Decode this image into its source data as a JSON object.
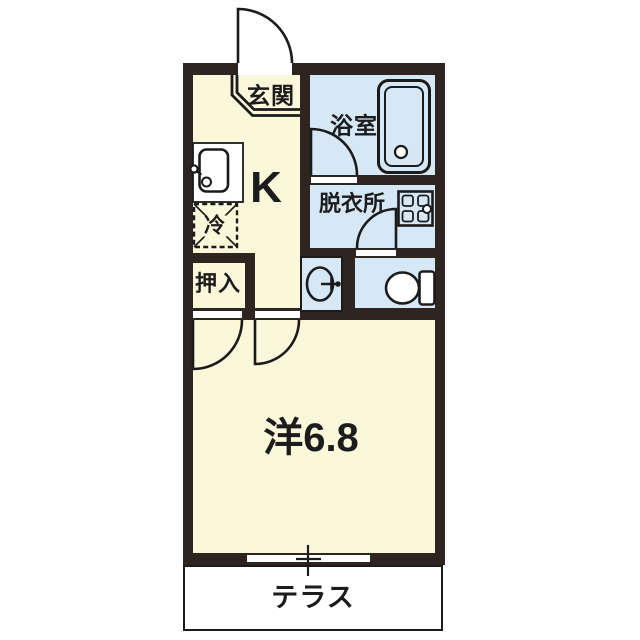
{
  "rooms": {
    "genkan": "玄関",
    "bathroom": "浴室",
    "kitchen": "K",
    "dressing_room": "脱衣所",
    "refrigerator": "冷",
    "closet": "押入",
    "western_room": "洋6.8",
    "terrace": "テラス"
  },
  "colors": {
    "wall": "#2e2420",
    "room_cream": "#fbf7da",
    "room_blue": "#d6e8f5",
    "line": "#1b1b1b",
    "background": "#ffffff"
  }
}
